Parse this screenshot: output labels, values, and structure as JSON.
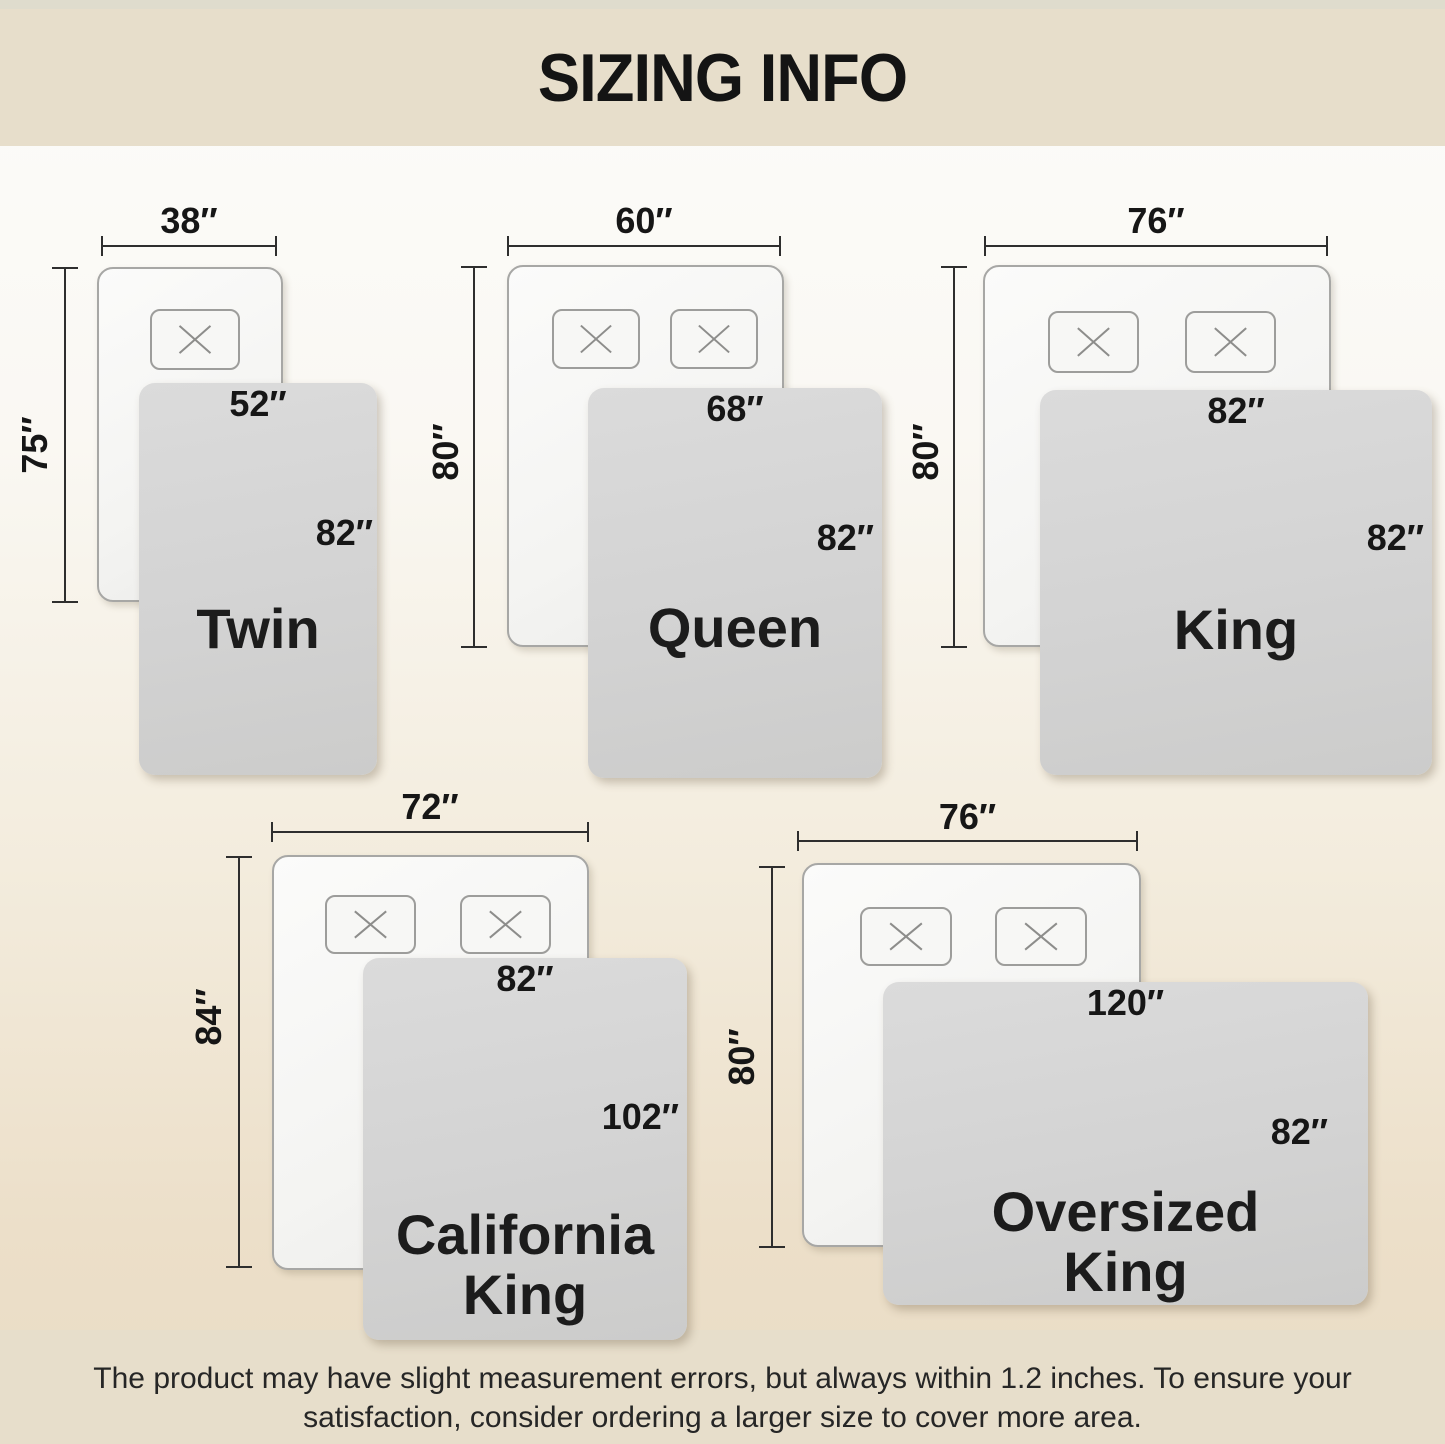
{
  "header": {
    "title": "SIZING INFO"
  },
  "footer": {
    "line1": "The product may have slight measurement errors, but always within 1.2 inches. To ensure your",
    "line2": "satisfaction, consider ordering a larger size to cover more area."
  },
  "diagrams": [
    {
      "name": "Twin",
      "bed_width": "38″",
      "bed_length": "75″",
      "blanket_width": "52″",
      "blanket_length": "82″",
      "pillows": 1
    },
    {
      "name": "Queen",
      "bed_width": "60″",
      "bed_length": "80″",
      "blanket_width": "68″",
      "blanket_length": "82″",
      "pillows": 2
    },
    {
      "name": "King",
      "bed_width": "76″",
      "bed_length": "80″",
      "blanket_width": "82″",
      "blanket_length": "82″",
      "pillows": 2
    },
    {
      "name": "California King",
      "bed_width": "72″",
      "bed_length": "84″",
      "blanket_width": "82″",
      "blanket_length": "102″",
      "pillows": 2
    },
    {
      "name": "Oversized King",
      "bed_width": "76″",
      "bed_length": "80″",
      "blanket_width": "120″",
      "blanket_length": "82″",
      "pillows": 2
    }
  ],
  "colors": {
    "band_beige": "#e7decb",
    "blanket_gray": "#d4d4d4",
    "bed_white": "#f6f6f4",
    "text_dark": "#1c1c1c"
  }
}
